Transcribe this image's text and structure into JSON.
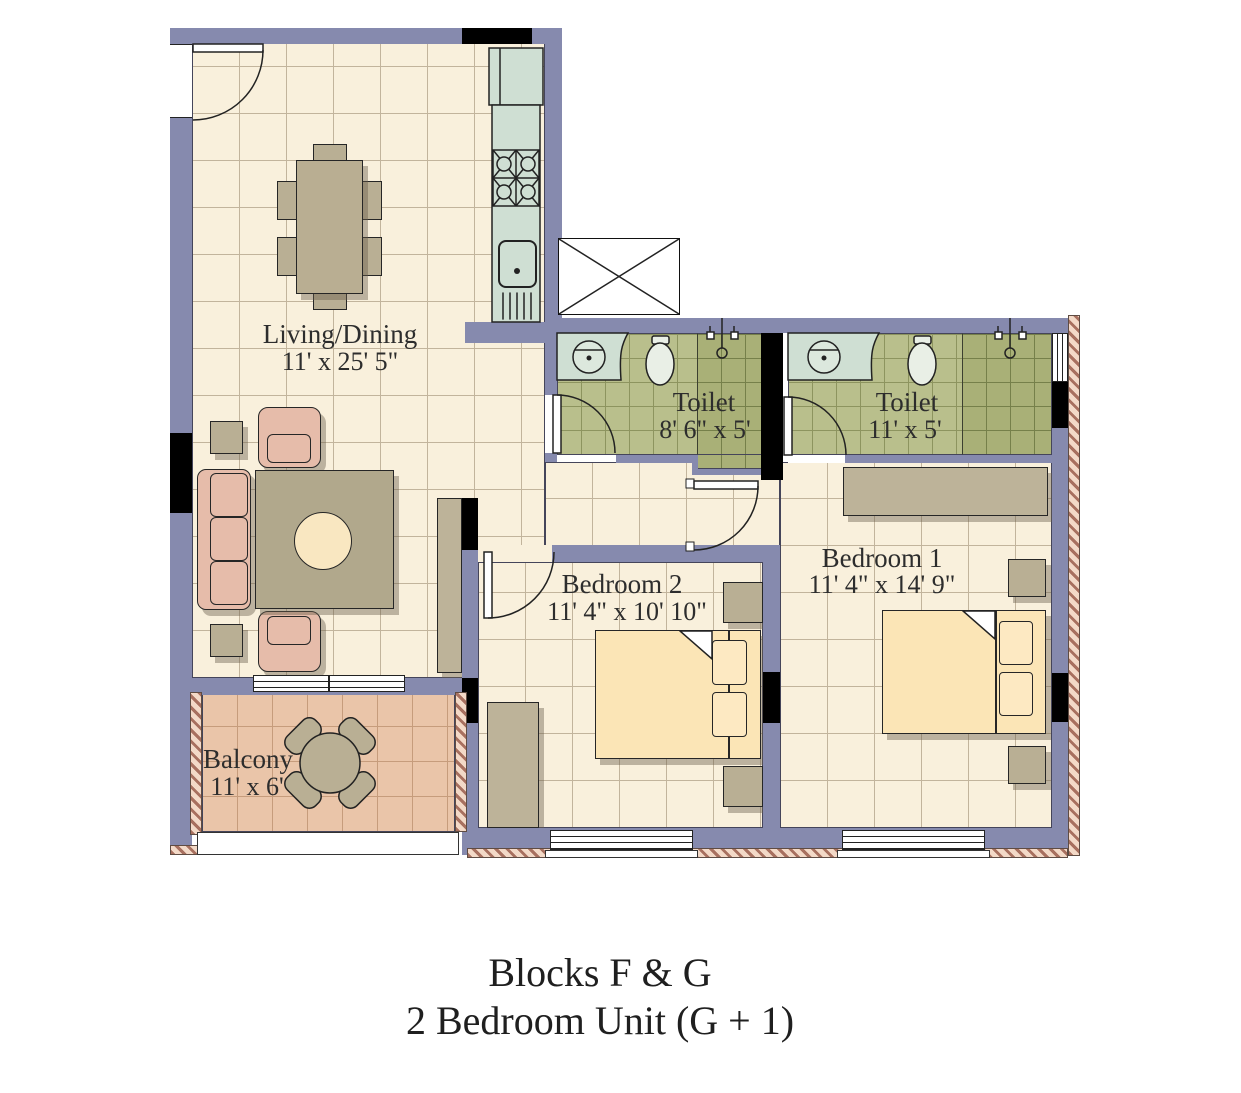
{
  "title": {
    "line1": "Blocks F & G",
    "line2": "2 Bedroom Unit (G + 1)"
  },
  "rooms": {
    "living": {
      "name": "Living/Dining",
      "dims": "11' x 25' 5\""
    },
    "toilet1": {
      "name": "Toilet",
      "dims": "8' 6\" x 5'"
    },
    "toilet2": {
      "name": "Toilet",
      "dims": "11' x 5'"
    },
    "bedroom2": {
      "name": "Bedroom 2",
      "dims": "11' 4\" x 10' 10\""
    },
    "bedroom1": {
      "name": "Bedroom 1",
      "dims": "11' 4\" x 14' 9\""
    },
    "balcony": {
      "name": "Balcony",
      "dims": "11' x 6'"
    }
  },
  "colors": {
    "wall": "#868aae",
    "floor": "#f9f0dc",
    "floorLine": "#c2b49c",
    "bathFloor": "#b9bf8c",
    "bathLine": "#8d945f",
    "bathDark": "#a9b077",
    "bathLineDark": "#76804a",
    "balcFloor": "#eac5a9",
    "balcLine": "#c69c7c",
    "counter": "#cfdfd3",
    "furn": "#b9af94",
    "rug": "#b1a88c",
    "rugCircle": "#f9e7c1",
    "sofa": "#e6bcaa",
    "bedsheet": "#fbe5b6",
    "pillow": "#fde9c2",
    "wardrobe": "#bdb399",
    "hatchA": "#a8705f",
    "hatchB": "#f3d9c7",
    "text": "#2d2d2d",
    "shadow": "rgba(104,92,74,0.42)"
  }
}
